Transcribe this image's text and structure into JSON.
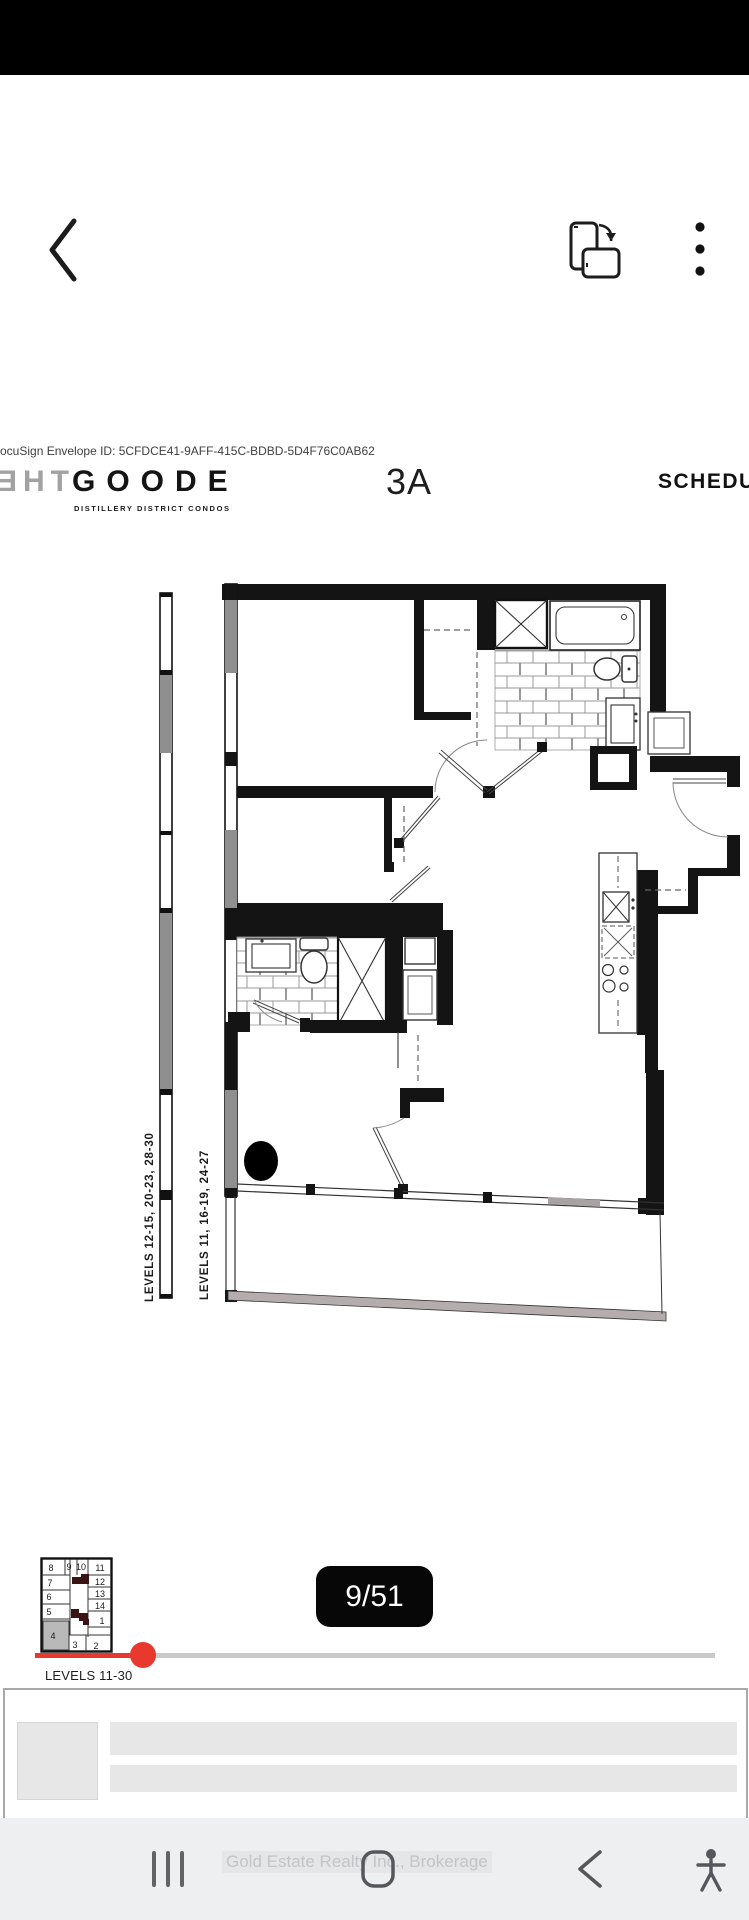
{
  "app_bar": {
    "back_icon": "back-chevron",
    "rotate_icon": "rotate-screen",
    "menu_icon": "overflow-menu"
  },
  "document": {
    "envelope_line": "ocuSign Envelope ID: 5CFDCE41-9AFF-415C-BDBD-5D4F76C0AB62",
    "logo": {
      "the": "ƎHT",
      "goode": "GOODE",
      "subtitle": "DISTILLERY DISTRICT CONDOS"
    },
    "unit_code": "3A",
    "schedule_label": "SCHEDU",
    "plan_labels": {
      "left": "LEVELS 12-15, 20-23, 28-30",
      "right": "LEVELS 11, 16-19, 24-27"
    }
  },
  "keyplan": {
    "units": [
      "8",
      "9",
      "10",
      "11",
      "7",
      "12",
      "6",
      "13",
      "5",
      "14",
      "1",
      "4",
      "3",
      "2"
    ],
    "highlighted_unit": "4",
    "caption": "LEVELS 11-30"
  },
  "pager": {
    "label": "9/51",
    "current_page": 9,
    "total_pages": 51
  },
  "nav_bar": {
    "watermark": "Gold Estate Realty Inc., Brokerage"
  },
  "colors": {
    "accent_red": "#e8392f",
    "badge_black": "#070707",
    "nav_bg": "#edeff1",
    "placeholder_gray": "#e7e7e7",
    "wall_black": "#141414",
    "window_gray": "#8f8f8f"
  }
}
